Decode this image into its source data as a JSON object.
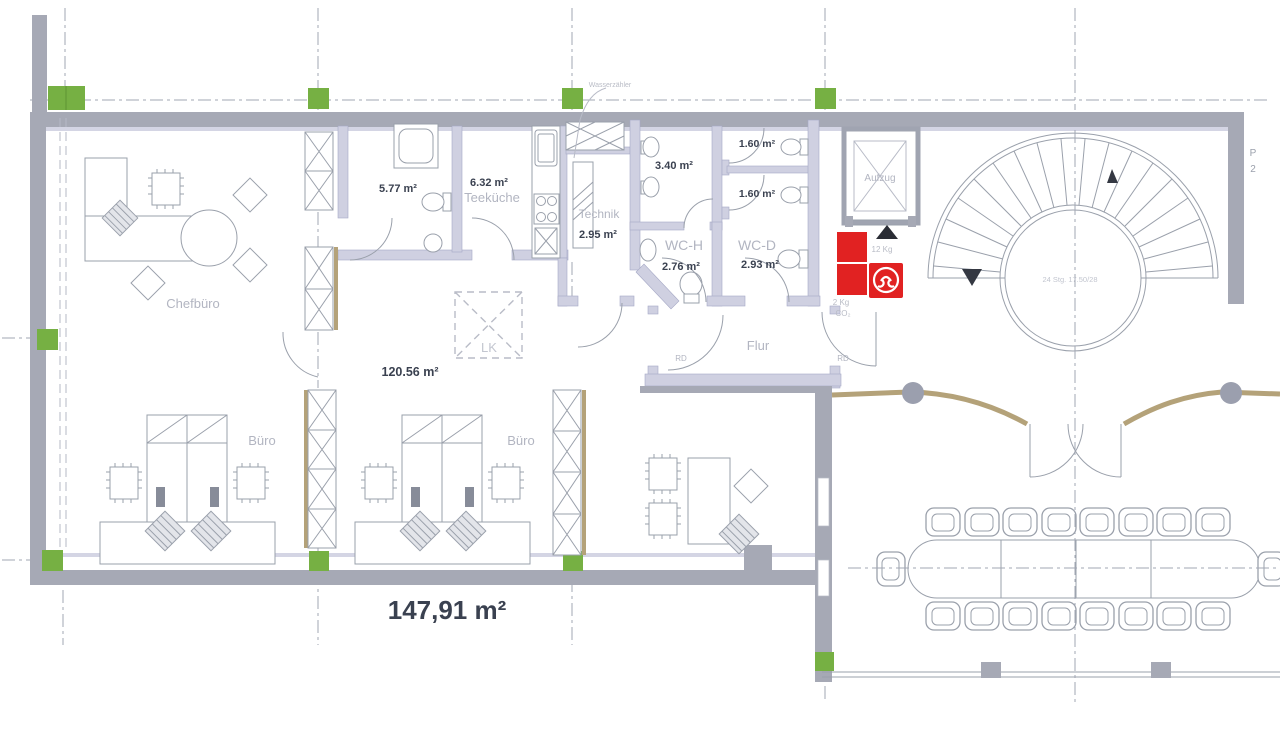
{
  "labels": {
    "chefbuero": "Chefbüro",
    "buero_1": "Büro",
    "buero_2": "Büro",
    "bad_area": "5.77 m²",
    "teekueche_area": "6.32 m²",
    "teekueche": "Teeküche",
    "technik": "Technik",
    "technik_area": "2.95 m²",
    "urinal_area": "3.40 m²",
    "wc_cabin1_area": "1.60 m²",
    "wc_cabin2_area": "1.60 m²",
    "wc_h": "WC-H",
    "wc_h_area": "2.76 m²",
    "wc_d": "WC-D",
    "wc_d_area": "2.93 m²",
    "flur": "Flur",
    "aufzug": "Aufzug",
    "rd_left": "RD",
    "rd_right": "RD",
    "lk": "LK",
    "open_space_area": "120.56 m²",
    "total_area": "147,91 m²",
    "stair_note": "24 Stg. 17.50/28",
    "ext_12kg": "12 Kg",
    "ext_2kg": "2 Kg",
    "ext_co2": "CO₂",
    "wasserzaehler": "Wasserzähler",
    "edge_label_1": "P",
    "edge_label_2": "2"
  },
  "colors": {
    "exterior_wall": "#a6a9b5",
    "partition_wall": "#cfd0e1",
    "column_marker_green": "#76b043",
    "glass_wall_tan": "#b4a279",
    "fire_equipment_red": "#e12222",
    "furniture_line": "#9aa0ab",
    "label_gray": "#b2b5c1",
    "label_dark": "#3a4150"
  }
}
